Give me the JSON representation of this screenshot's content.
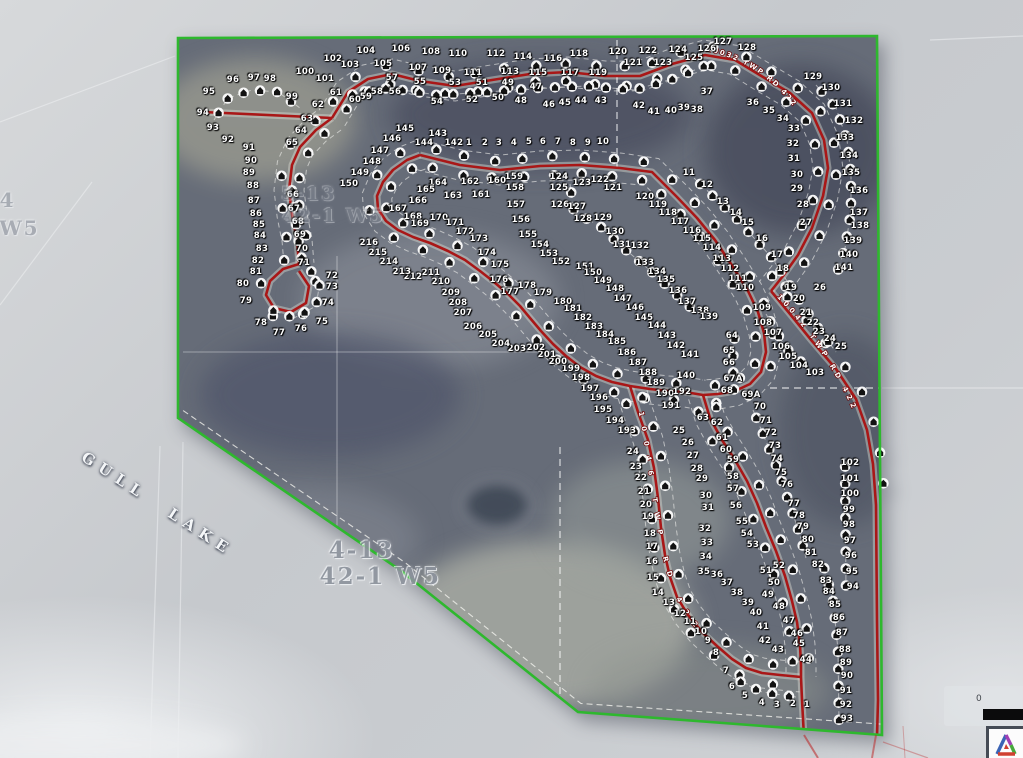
{
  "map_title": "Gull Lake subdivision aerial plat map",
  "lake_label": {
    "text": "GULL LAKE"
  },
  "township_labels": [
    {
      "text": "4-13",
      "x": 330,
      "y": 537,
      "size": 23,
      "opacity": 0.9
    },
    {
      "text": "42-1 W5",
      "x": 322,
      "y": 563,
      "size": 23,
      "opacity": 0.9
    },
    {
      "text": "5-13",
      "x": 282,
      "y": 183,
      "size": 19,
      "opacity": 0.38
    },
    {
      "text": "42-1 W5",
      "x": 284,
      "y": 205,
      "size": 19,
      "opacity": 0.42
    },
    {
      "text": "4",
      "x": 0,
      "y": 188,
      "size": 20,
      "opacity": 0.6
    },
    {
      "text": "W5",
      "x": 0,
      "y": 216,
      "size": 20,
      "opacity": 0.6
    }
  ],
  "road_labels": [
    {
      "text": "10032 TWP RD 422",
      "path": "lblA",
      "spacing": "2px"
    },
    {
      "text": "10042 TWP RD 422",
      "path": "lblB",
      "spacing": "4px"
    },
    {
      "text": "10046 TWP RD 422",
      "path": "lblC",
      "spacing": "10px"
    }
  ],
  "scale_bar": {
    "zero": "0"
  },
  "logo": {
    "name": "surveyor-triangle-logo"
  },
  "colors": {
    "boundary_green": "#2eb82e",
    "road_red": "#a91717",
    "outside_gray": "#c9ccd0",
    "interior_gray": "#666c78"
  },
  "lots": [
    [
      104,
      366,
      51
    ],
    [
      105,
      383,
      64
    ],
    [
      106,
      401,
      49
    ],
    [
      107,
      418,
      68
    ],
    [
      108,
      431,
      52
    ],
    [
      109,
      442,
      71
    ],
    [
      110,
      458,
      54
    ],
    [
      111,
      473,
      73
    ],
    [
      112,
      496,
      54
    ],
    [
      113,
      510,
      72
    ],
    [
      114,
      523,
      57
    ],
    [
      115,
      538,
      73
    ],
    [
      116,
      553,
      59
    ],
    [
      117,
      570,
      73
    ],
    [
      118,
      579,
      54
    ],
    [
      119,
      598,
      73
    ],
    [
      120,
      618,
      52
    ],
    [
      121,
      633,
      63
    ],
    [
      122,
      648,
      51
    ],
    [
      123,
      663,
      63
    ],
    [
      124,
      678,
      50
    ],
    [
      125,
      694,
      58
    ],
    [
      126,
      707,
      49
    ],
    [
      127,
      723,
      42
    ],
    [
      128,
      747,
      48
    ],
    [
      100,
      305,
      72
    ],
    [
      101,
      325,
      79
    ],
    [
      102,
      333,
      59
    ],
    [
      103,
      350,
      65
    ],
    [
      96,
      233,
      80
    ],
    [
      97,
      254,
      78
    ],
    [
      98,
      270,
      79
    ],
    [
      95,
      209,
      92
    ],
    [
      94,
      203,
      113
    ],
    [
      99,
      292,
      97
    ],
    [
      43,
      601,
      101
    ],
    [
      44,
      581,
      101
    ],
    [
      45,
      565,
      103
    ],
    [
      46,
      549,
      105
    ],
    [
      47,
      536,
      87
    ],
    [
      48,
      521,
      101
    ],
    [
      49,
      508,
      83
    ],
    [
      50,
      498,
      98
    ],
    [
      51,
      482,
      83
    ],
    [
      52,
      472,
      100
    ],
    [
      53,
      455,
      83
    ],
    [
      54,
      437,
      102
    ],
    [
      55,
      420,
      82
    ],
    [
      56,
      395,
      92
    ],
    [
      57,
      392,
      78
    ],
    [
      58,
      377,
      92
    ],
    [
      59,
      366,
      97
    ],
    [
      60,
      355,
      100
    ],
    [
      61,
      336,
      93
    ],
    [
      62,
      318,
      105
    ],
    [
      63,
      307,
      119
    ],
    [
      64,
      301,
      131
    ],
    [
      65,
      292,
      143
    ],
    [
      66,
      293,
      195
    ],
    [
      67,
      294,
      209
    ],
    [
      68,
      298,
      222
    ],
    [
      69,
      300,
      235
    ],
    [
      70,
      302,
      249
    ],
    [
      71,
      304,
      263
    ],
    [
      72,
      332,
      276
    ],
    [
      73,
      332,
      287
    ],
    [
      74,
      328,
      303
    ],
    [
      75,
      322,
      322
    ],
    [
      76,
      301,
      329
    ],
    [
      77,
      279,
      333
    ],
    [
      78,
      261,
      323
    ],
    [
      79,
      246,
      301
    ],
    [
      80,
      243,
      284
    ],
    [
      81,
      256,
      272
    ],
    [
      82,
      258,
      261
    ],
    [
      83,
      262,
      249
    ],
    [
      84,
      260,
      236
    ],
    [
      85,
      259,
      225
    ],
    [
      86,
      256,
      214
    ],
    [
      87,
      254,
      201
    ],
    [
      88,
      253,
      186
    ],
    [
      89,
      249,
      173
    ],
    [
      90,
      251,
      161
    ],
    [
      91,
      249,
      148
    ],
    [
      92,
      228,
      140
    ],
    [
      93,
      213,
      128
    ],
    [
      42,
      639,
      106
    ],
    [
      41,
      654,
      112
    ],
    [
      40,
      671,
      111
    ],
    [
      39,
      684,
      108
    ],
    [
      38,
      697,
      110
    ],
    [
      37,
      707,
      92
    ],
    [
      36,
      753,
      103
    ],
    [
      35,
      769,
      111
    ],
    [
      34,
      783,
      119
    ],
    [
      33,
      794,
      129
    ],
    [
      32,
      793,
      144
    ],
    [
      31,
      794,
      159
    ],
    [
      30,
      797,
      175
    ],
    [
      129,
      813,
      77
    ],
    [
      130,
      831,
      88
    ],
    [
      131,
      843,
      104
    ],
    [
      132,
      854,
      121
    ],
    [
      133,
      845,
      138
    ],
    [
      134,
      849,
      156
    ],
    [
      135,
      851,
      173
    ],
    [
      136,
      859,
      191
    ],
    [
      137,
      859,
      213
    ],
    [
      138,
      860,
      226
    ],
    [
      139,
      853,
      241
    ],
    [
      140,
      849,
      255
    ],
    [
      141,
      844,
      268
    ],
    [
      11,
      689,
      173
    ],
    [
      12,
      707,
      185
    ],
    [
      13,
      723,
      202
    ],
    [
      14,
      736,
      213
    ],
    [
      15,
      748,
      223
    ],
    [
      16,
      762,
      239
    ],
    [
      17,
      777,
      255
    ],
    [
      18,
      783,
      269
    ],
    [
      19,
      791,
      288
    ],
    [
      20,
      799,
      299
    ],
    [
      21,
      806,
      313
    ],
    [
      22,
      813,
      323
    ],
    [
      23,
      819,
      332
    ],
    [
      24,
      830,
      339
    ],
    [
      25,
      841,
      347
    ],
    [
      26,
      820,
      288
    ],
    [
      27,
      806,
      223
    ],
    [
      28,
      803,
      205
    ],
    [
      29,
      797,
      189
    ],
    [
      142,
      454,
      143
    ],
    [
      1,
      469,
      143
    ],
    [
      2,
      485,
      143
    ],
    [
      3,
      499,
      143
    ],
    [
      4,
      514,
      143
    ],
    [
      5,
      529,
      142
    ],
    [
      6,
      543,
      142
    ],
    [
      7,
      558,
      142
    ],
    [
      8,
      573,
      143
    ],
    [
      9,
      588,
      143
    ],
    [
      10,
      603,
      142
    ],
    [
      143,
      438,
      134
    ],
    [
      144,
      424,
      143
    ],
    [
      145,
      405,
      129
    ],
    [
      146,
      392,
      139
    ],
    [
      147,
      380,
      151
    ],
    [
      148,
      372,
      162
    ],
    [
      149,
      360,
      173
    ],
    [
      150,
      349,
      184
    ],
    [
      151,
      585,
      267
    ],
    [
      152,
      561,
      262
    ],
    [
      153,
      549,
      254
    ],
    [
      154,
      540,
      245
    ],
    [
      155,
      528,
      235
    ],
    [
      156,
      521,
      220
    ],
    [
      157,
      516,
      205
    ],
    [
      158,
      515,
      188
    ],
    [
      159,
      514,
      177
    ],
    [
      160,
      497,
      181
    ],
    [
      161,
      481,
      195
    ],
    [
      162,
      470,
      182
    ],
    [
      163,
      453,
      196
    ],
    [
      164,
      438,
      183
    ],
    [
      165,
      426,
      190
    ],
    [
      166,
      418,
      201
    ],
    [
      167,
      398,
      209
    ],
    [
      168,
      413,
      217
    ],
    [
      169,
      420,
      224
    ],
    [
      170,
      439,
      218
    ],
    [
      171,
      455,
      223
    ],
    [
      172,
      465,
      232
    ],
    [
      173,
      479,
      239
    ],
    [
      174,
      487,
      253
    ],
    [
      175,
      500,
      265
    ],
    [
      176,
      499,
      280
    ],
    [
      177,
      510,
      292
    ],
    [
      178,
      527,
      286
    ],
    [
      179,
      543,
      293
    ],
    [
      180,
      563,
      302
    ],
    [
      181,
      573,
      309
    ],
    [
      182,
      583,
      318
    ],
    [
      183,
      594,
      327
    ],
    [
      184,
      605,
      335
    ],
    [
      185,
      617,
      342
    ],
    [
      186,
      627,
      353
    ],
    [
      187,
      638,
      363
    ],
    [
      188,
      648,
      373
    ],
    [
      189,
      656,
      383
    ],
    [
      190,
      665,
      394
    ],
    [
      191,
      671,
      406
    ],
    [
      192,
      682,
      392
    ],
    [
      193,
      627,
      431
    ],
    [
      194,
      615,
      421
    ],
    [
      195,
      603,
      410
    ],
    [
      196,
      599,
      398
    ],
    [
      197,
      590,
      389
    ],
    [
      198,
      581,
      378
    ],
    [
      199,
      571,
      369
    ],
    [
      200,
      558,
      362
    ],
    [
      201,
      547,
      355
    ],
    [
      202,
      536,
      348
    ],
    [
      203,
      517,
      349
    ],
    [
      204,
      501,
      344
    ],
    [
      205,
      488,
      335
    ],
    [
      206,
      473,
      327
    ],
    [
      207,
      463,
      313
    ],
    [
      208,
      458,
      303
    ],
    [
      209,
      451,
      293
    ],
    [
      210,
      441,
      282
    ],
    [
      211,
      431,
      273
    ],
    [
      212,
      413,
      277
    ],
    [
      213,
      402,
      272
    ],
    [
      214,
      389,
      262
    ],
    [
      215,
      378,
      253
    ],
    [
      216,
      369,
      243
    ],
    [
      150,
      593,
      273
    ],
    [
      149,
      603,
      281
    ],
    [
      148,
      615,
      289
    ],
    [
      147,
      623,
      299
    ],
    [
      146,
      635,
      308
    ],
    [
      145,
      644,
      318
    ],
    [
      144,
      657,
      326
    ],
    [
      143,
      667,
      336
    ],
    [
      142,
      676,
      346
    ],
    [
      141,
      690,
      355
    ],
    [
      140,
      686,
      376
    ],
    [
      121,
      613,
      188
    ],
    [
      122,
      600,
      180
    ],
    [
      123,
      582,
      183
    ],
    [
      124,
      559,
      177
    ],
    [
      125,
      559,
      188
    ],
    [
      126,
      560,
      205
    ],
    [
      127,
      577,
      207
    ],
    [
      128,
      583,
      219
    ],
    [
      129,
      603,
      218
    ],
    [
      130,
      615,
      232
    ],
    [
      131,
      622,
      245
    ],
    [
      132,
      640,
      246
    ],
    [
      133,
      645,
      263
    ],
    [
      134,
      657,
      272
    ],
    [
      135,
      666,
      280
    ],
    [
      136,
      678,
      291
    ],
    [
      137,
      687,
      302
    ],
    [
      138,
      700,
      311
    ],
    [
      139,
      709,
      317
    ],
    [
      120,
      645,
      197
    ],
    [
      119,
      658,
      205
    ],
    [
      118,
      668,
      213
    ],
    [
      117,
      680,
      222
    ],
    [
      116,
      692,
      231
    ],
    [
      115,
      702,
      239
    ],
    [
      114,
      712,
      248
    ],
    [
      113,
      722,
      259
    ],
    [
      112,
      730,
      269
    ],
    [
      111,
      738,
      279
    ],
    [
      110,
      745,
      288
    ],
    [
      109,
      762,
      308
    ],
    [
      108,
      763,
      323
    ],
    [
      107,
      773,
      333
    ],
    [
      106,
      781,
      347
    ],
    [
      105,
      788,
      357
    ],
    [
      104,
      799,
      366
    ],
    [
      103,
      815,
      373
    ],
    [
      64,
      732,
      336
    ],
    [
      65,
      729,
      351
    ],
    [
      66,
      729,
      363
    ],
    [
      "67A",
      733,
      379
    ],
    [
      68,
      727,
      391
    ],
    [
      "69A",
      751,
      395
    ],
    [
      70,
      760,
      407
    ],
    [
      71,
      766,
      421
    ],
    [
      72,
      771,
      433
    ],
    [
      73,
      775,
      446
    ],
    [
      74,
      777,
      459
    ],
    [
      75,
      781,
      473
    ],
    [
      76,
      787,
      485
    ],
    [
      77,
      794,
      504
    ],
    [
      78,
      799,
      516
    ],
    [
      79,
      803,
      527
    ],
    [
      80,
      808,
      540
    ],
    [
      81,
      811,
      553
    ],
    [
      82,
      818,
      565
    ],
    [
      83,
      826,
      581
    ],
    [
      84,
      829,
      592
    ],
    [
      85,
      835,
      605
    ],
    [
      86,
      839,
      618
    ],
    [
      87,
      842,
      633
    ],
    [
      88,
      845,
      650
    ],
    [
      89,
      846,
      663
    ],
    [
      90,
      847,
      676
    ],
    [
      91,
      846,
      691
    ],
    [
      92,
      846,
      705
    ],
    [
      93,
      847,
      719
    ],
    [
      102,
      850,
      463
    ],
    [
      101,
      850,
      479
    ],
    [
      100,
      850,
      494
    ],
    [
      99,
      849,
      510
    ],
    [
      98,
      849,
      525
    ],
    [
      97,
      850,
      541
    ],
    [
      96,
      851,
      556
    ],
    [
      95,
      852,
      572
    ],
    [
      94,
      853,
      587
    ],
    [
      24,
      633,
      452
    ],
    [
      23,
      636,
      467
    ],
    [
      22,
      641,
      478
    ],
    [
      21,
      644,
      492
    ],
    [
      20,
      646,
      505
    ],
    [
      19,
      648,
      517
    ],
    [
      18,
      650,
      534
    ],
    [
      17,
      652,
      547
    ],
    [
      16,
      652,
      562
    ],
    [
      15,
      653,
      578
    ],
    [
      14,
      658,
      593
    ],
    [
      13,
      669,
      603
    ],
    [
      12,
      680,
      614
    ],
    [
      11,
      690,
      622
    ],
    [
      10,
      701,
      632
    ],
    [
      9,
      708,
      641
    ],
    [
      8,
      716,
      653
    ],
    [
      7,
      726,
      671
    ],
    [
      6,
      732,
      687
    ],
    [
      5,
      745,
      696
    ],
    [
      4,
      762,
      703
    ],
    [
      3,
      777,
      705
    ],
    [
      2,
      793,
      704
    ],
    [
      1,
      807,
      705
    ],
    [
      25,
      679,
      431
    ],
    [
      26,
      688,
      443
    ],
    [
      27,
      693,
      456
    ],
    [
      28,
      697,
      469
    ],
    [
      29,
      702,
      479
    ],
    [
      30,
      706,
      496
    ],
    [
      31,
      708,
      508
    ],
    [
      32,
      705,
      529
    ],
    [
      33,
      707,
      543
    ],
    [
      34,
      706,
      557
    ],
    [
      35,
      704,
      572
    ],
    [
      36,
      717,
      575
    ],
    [
      37,
      727,
      583
    ],
    [
      38,
      737,
      593
    ],
    [
      39,
      748,
      603
    ],
    [
      40,
      756,
      613
    ],
    [
      41,
      763,
      627
    ],
    [
      42,
      765,
      641
    ],
    [
      43,
      778,
      650
    ],
    [
      44,
      806,
      660
    ],
    [
      45,
      799,
      644
    ],
    [
      46,
      797,
      634
    ],
    [
      47,
      789,
      621
    ],
    [
      48,
      779,
      607
    ],
    [
      49,
      768,
      595
    ],
    [
      50,
      774,
      583
    ],
    [
      51,
      766,
      571
    ],
    [
      52,
      779,
      566
    ],
    [
      53,
      753,
      545
    ],
    [
      54,
      747,
      534
    ],
    [
      55,
      742,
      522
    ],
    [
      56,
      736,
      506
    ],
    [
      57,
      733,
      489
    ],
    [
      58,
      733,
      477
    ],
    [
      59,
      733,
      460
    ],
    [
      60,
      726,
      450
    ],
    [
      61,
      722,
      438
    ],
    [
      62,
      717,
      423
    ],
    [
      63,
      703,
      418
    ]
  ]
}
